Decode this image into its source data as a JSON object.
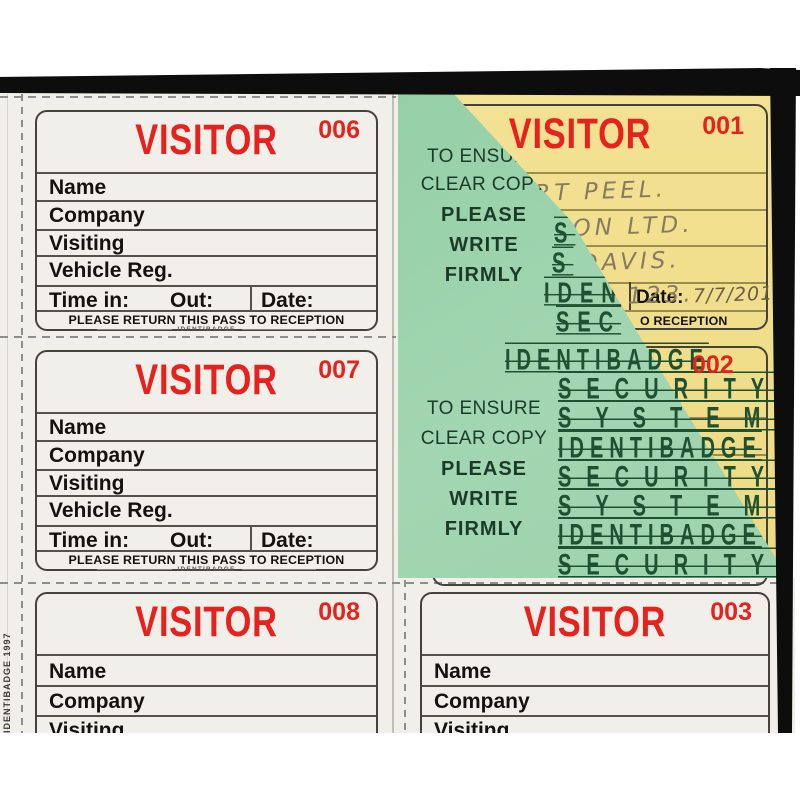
{
  "colors": {
    "visitor_red": "#e7211c",
    "sheet_green": "#9cd2ac",
    "ink_green": "#1b3a28",
    "copy_yellow": "#f2e08c",
    "paper_white": "#f1efe9",
    "frame_black": "#0d0d0d"
  },
  "pass_labels": {
    "title": "VISITOR",
    "name": "Name",
    "company": "Company",
    "visiting": "Visiting",
    "vehicle_reg": "Vehicle Reg.",
    "time_in": "Time in:",
    "out": "Out:",
    "date": "Date:",
    "footer": "PLEASE RETURN THIS PASS TO RECEPTION",
    "brand": "IDENTIBADGE"
  },
  "pass_numbers": {
    "p001": "001",
    "p002": "002",
    "p003": "003",
    "p006": "006",
    "p007": "007",
    "p008": "008"
  },
  "green_sheet": {
    "instructions": [
      "TO ENSURE",
      "CLEAR COPY",
      "PLEASE",
      "WRITE",
      "FIRMLY"
    ],
    "security_fragments": [
      "S",
      "S",
      "IDEN",
      "SEC"
    ],
    "security_rows": [
      "IDENTIBADGE",
      "SECURITY",
      "SYSTEM",
      "IDENTIBADGE",
      "SECURITY",
      "SYSTEM",
      "IDENTIBADGE",
      "SECURITY"
    ]
  },
  "filled_pass": {
    "name": "ERT PEEL.",
    "company": "SON LTD.",
    "visiting": "DAVIS.",
    "vehicle_reg": "C 123.",
    "date": "7/7/201",
    "reception_fragment": "O RECEPTION"
  },
  "edge_note": "IDENTIBADGE 1997"
}
